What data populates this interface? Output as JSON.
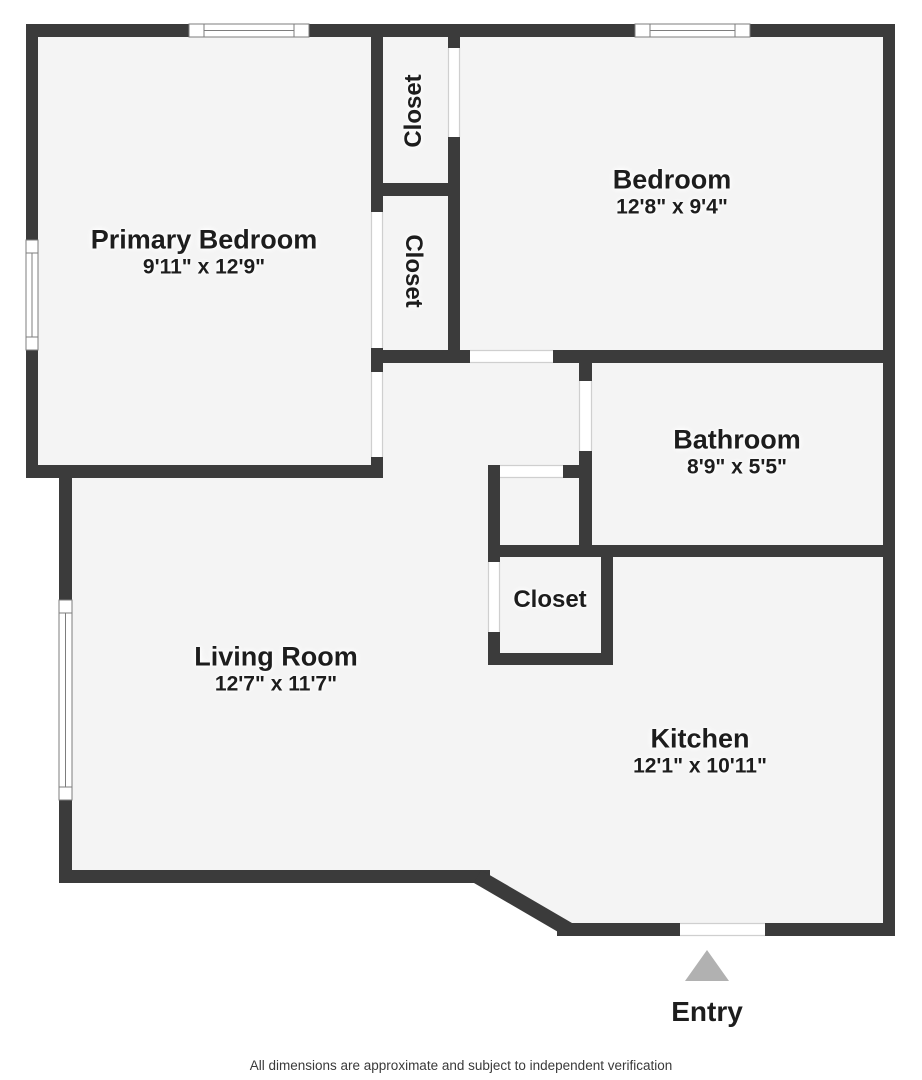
{
  "plan": {
    "rooms": [
      {
        "id": "primary-bedroom",
        "name": "Primary Bedroom",
        "dimensions": "9'11\" x 12'9\""
      },
      {
        "id": "bedroom",
        "name": "Bedroom",
        "dimensions": "12'8\" x 9'4\""
      },
      {
        "id": "bathroom",
        "name": "Bathroom",
        "dimensions": "8'9\" x 5'5\""
      },
      {
        "id": "living-room",
        "name": "Living Room",
        "dimensions": "12'7\" x 11'7\""
      },
      {
        "id": "kitchen",
        "name": "Kitchen",
        "dimensions": "12'1\" x 10'11\""
      },
      {
        "id": "closet-top",
        "name": "Closet"
      },
      {
        "id": "closet-middle",
        "name": "Closet"
      },
      {
        "id": "closet-hall",
        "name": "Closet"
      }
    ],
    "entry": {
      "label": "Entry",
      "marker": "triangle-up-icon"
    },
    "footer": {
      "disclaimer": "All dimensions are approximate and subject to independent verification"
    },
    "colors": {
      "wall": "#3b3b3b",
      "floor": "#f4f4f4",
      "background": "#ffffff",
      "door_frame": "#cfcfcf",
      "window_frame": "#7d7d7d",
      "entry_arrow": "#b1b1b1",
      "text": "#1d1d1d"
    }
  }
}
